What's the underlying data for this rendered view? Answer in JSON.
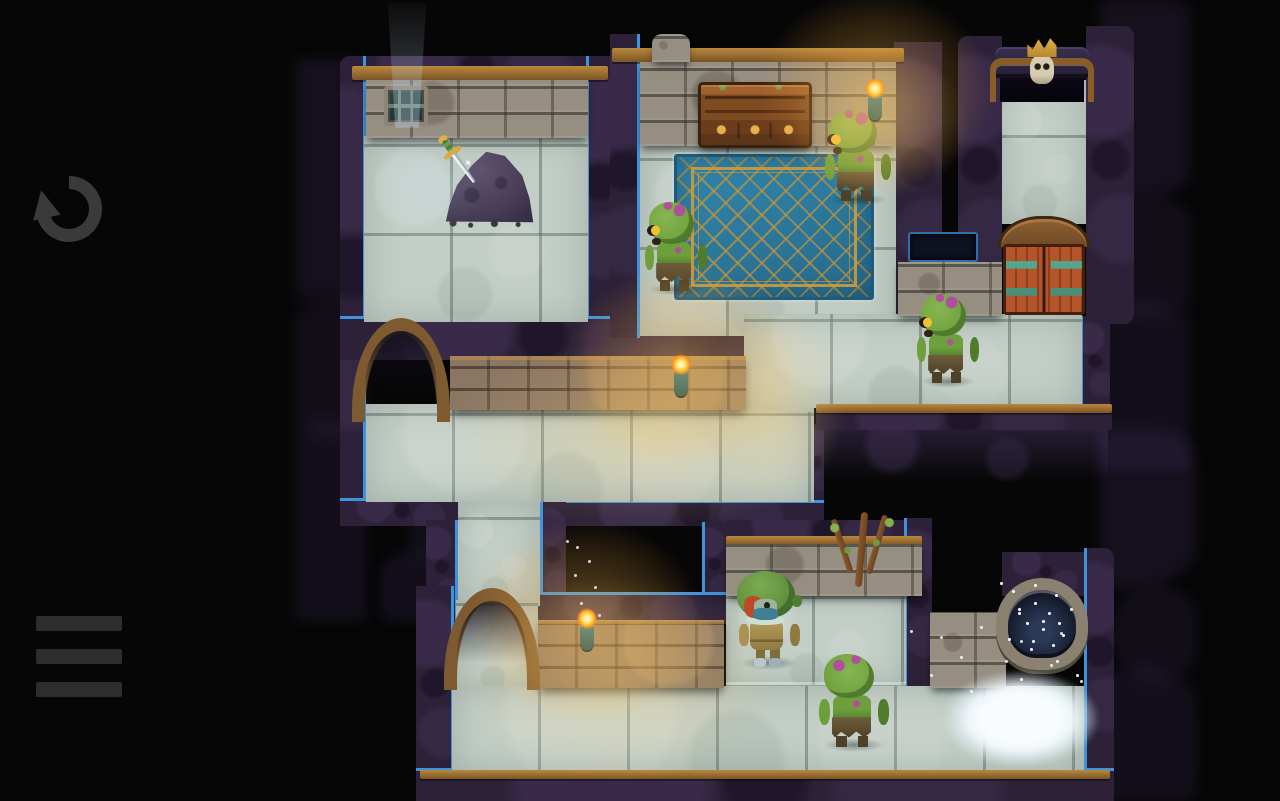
{
  "canvas": {
    "width": 1280,
    "height": 801
  },
  "hud": {
    "undo_button": {
      "icon": "undo-arrow-icon",
      "color": "#3a3a3a"
    },
    "menu_button": {
      "icon": "hamburger-menu-icon",
      "color": "#2d2d2d",
      "bar_count": 3
    }
  },
  "palette": {
    "bg": "#060606",
    "ui_icon": "#3a3a3a",
    "ui_icon_dim": "#2d2d2d",
    "wall": "#2c2138",
    "edge_blue": "#3f93da",
    "trim": "#b9883d",
    "trim_dark": "#7c5526",
    "stone": "#968e81",
    "brick": "#8b7663",
    "floor": "#c3cec6",
    "floor_lit": "#efe9c6",
    "rug": "#2a7598",
    "rug_dark": "#1f5a78",
    "rug_gold": "#c9953a",
    "zombie": "#6da03c",
    "zombie_light": "#86b652",
    "zombie_dark": "#4f7c2a",
    "zombie_spot": "#b14f9e",
    "zombie_eye": "#efc232",
    "pants": "#6f5d3b",
    "pants_dark": "#4e4128",
    "hood": "#5d8a3a",
    "hood_dark": "#4f7c33",
    "hair": "#bf4a2a",
    "mask": "#3f7f93",
    "outfit": "#b29a58",
    "outfit_dark": "#8f7a42",
    "boots": "#b9c6cf",
    "flame": "#ffd23c",
    "flame_core": "#fff6c0",
    "flame_deep": "#ff8d1d",
    "sconce": "#3c5a52",
    "door_red": "#b4552c",
    "door_red_dark": "#8f3e1e",
    "hinge": "#55a58c",
    "skull": "#d6ccb0",
    "crown": "#e0b44a",
    "well_stone": "#8a8171",
    "pool": "#121828",
    "pool_light": "#2c3a58",
    "mist": "#f8fcff",
    "rubble": "#473d56",
    "rubble_light": "#5f5370",
    "vine": "#6b421f",
    "glow_warm": "rgba(255,215,120,0.30)",
    "glow_cool": "rgba(190,215,245,0.20)"
  },
  "scene": {
    "name": "dungeon-level",
    "entities": [
      {
        "type": "rug",
        "name": "patterned-rug",
        "x": 674,
        "y": 154,
        "w": 200,
        "h": 146,
        "interactable": false
      },
      {
        "type": "window",
        "name": "barred-window",
        "x": 384,
        "y": 86,
        "w": 44,
        "h": 40,
        "interactable": false
      },
      {
        "type": "cabinet",
        "name": "wooden-cabinet",
        "x": 698,
        "y": 82,
        "w": 114,
        "h": 66,
        "interactable": false
      },
      {
        "type": "rubble",
        "name": "rubble-pile",
        "x": 444,
        "y": 146,
        "w": 92,
        "h": 82,
        "interactable": false
      },
      {
        "type": "sword",
        "name": "sword-in-rubble",
        "x": 452,
        "y": 126,
        "w": 50,
        "h": 64,
        "interactable": true
      },
      {
        "type": "skullgate",
        "name": "skull-crowned-gate",
        "x": 990,
        "y": 36,
        "w": 104,
        "h": 66,
        "interactable": true
      },
      {
        "type": "reddoors",
        "name": "red-double-doors",
        "x": 998,
        "y": 216,
        "w": 92,
        "h": 102,
        "interactable": true
      },
      {
        "type": "vine",
        "name": "withered-vine",
        "x": 826,
        "y": 512,
        "w": 72,
        "h": 96,
        "interactable": false
      },
      {
        "type": "well",
        "name": "stone-well",
        "x": 996,
        "y": 578,
        "w": 92,
        "h": 100,
        "interactable": false
      },
      {
        "type": "zombie",
        "name": "zombie-rug-left",
        "x": 644,
        "y": 202,
        "w": 64,
        "h": 92,
        "facing": "left",
        "interactable": true
      },
      {
        "type": "zombie",
        "name": "zombie-rug-right",
        "x": 824,
        "y": 110,
        "w": 68,
        "h": 94,
        "facing": "left",
        "interactable": true
      },
      {
        "type": "zombie",
        "name": "zombie-east-hall",
        "x": 916,
        "y": 294,
        "w": 64,
        "h": 92,
        "facing": "left",
        "interactable": true
      },
      {
        "type": "zombieback",
        "name": "zombie-south-room",
        "x": 818,
        "y": 654,
        "w": 72,
        "h": 96,
        "interactable": true
      },
      {
        "type": "player",
        "name": "hooded-hero",
        "x": 736,
        "y": 570,
        "w": 66,
        "h": 98,
        "interactable": true
      },
      {
        "type": "torch",
        "name": "wall-torch-north",
        "x": 858,
        "y": 62,
        "w": 34,
        "h": 64,
        "interactable": false
      },
      {
        "type": "torch",
        "name": "wall-torch-mid",
        "x": 664,
        "y": 338,
        "w": 34,
        "h": 64,
        "interactable": false
      },
      {
        "type": "torch",
        "name": "wall-torch-south",
        "x": 570,
        "y": 592,
        "w": 34,
        "h": 64,
        "interactable": false
      },
      {
        "type": "lightpool",
        "name": "torch-light-mid",
        "x": 430,
        "y": 336,
        "w": 420,
        "h": 200,
        "interactable": false
      },
      {
        "type": "lightpool",
        "name": "column-light",
        "x": 700,
        "y": 292,
        "w": 150,
        "h": 220,
        "interactable": false
      },
      {
        "type": "lightpool",
        "name": "torch-light-south",
        "x": 448,
        "y": 572,
        "w": 340,
        "h": 216,
        "interactable": false
      },
      {
        "type": "lightpool",
        "name": "torch-light-north",
        "x": 784,
        "y": 44,
        "w": 190,
        "h": 160,
        "interactable": false
      },
      {
        "type": "lightpoolcool",
        "name": "window-light",
        "x": 368,
        "y": 120,
        "w": 120,
        "h": 130,
        "interactable": false
      },
      {
        "type": "lightbeam",
        "name": "window-light-beam",
        "x": 386,
        "y": 2,
        "w": 42,
        "h": 126,
        "interactable": false
      },
      {
        "type": "mist",
        "name": "frost-mist",
        "x": 910,
        "y": 648,
        "w": 202,
        "h": 130,
        "interactable": false
      },
      {
        "type": "sparkles",
        "name": "well-sparkles",
        "x": 1000,
        "y": 582,
        "w": 90,
        "h": 112,
        "variant": "well",
        "interactable": false
      },
      {
        "type": "sparkles",
        "name": "dripping-sparkles",
        "x": 566,
        "y": 540,
        "w": 48,
        "h": 80,
        "variant": "drips",
        "interactable": false
      }
    ]
  }
}
